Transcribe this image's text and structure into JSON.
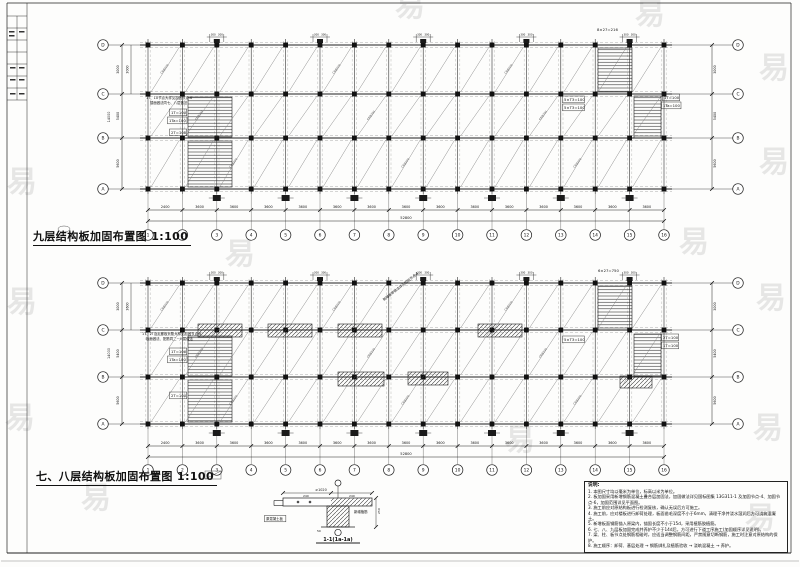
{
  "sheet": {
    "bg": "#fdfdfc",
    "line_color": "#1f1f1f",
    "light_line_color": "#8a8a8a",
    "watermark_glyph": "易",
    "watermark_color": "#8f8f8f"
  },
  "titles": {
    "plan_top": "九层结构板加固布置图 1:100",
    "plan_bottom": "七、八层结构板加固布置图 1:100"
  },
  "plans": [
    {
      "id": "plan-9f",
      "name": "ninth-floor-plan",
      "x0": 148,
      "spacing": 34.4,
      "cols": [
        "1",
        "2",
        "3",
        "4",
        "5",
        "6",
        "7",
        "8",
        "9",
        "10",
        "11",
        "12",
        "13",
        "14",
        "15",
        "16"
      ],
      "rows": [
        {
          "label": "D",
          "y": 45
        },
        {
          "label": "C",
          "y": 94
        },
        {
          "label": "B",
          "y": 138
        },
        {
          "label": "A",
          "y": 189
        }
      ],
      "bottom_dims": [
        "2400",
        "3600",
        "3600",
        "3600",
        "3600",
        "3600",
        "3600",
        "3600",
        "3600",
        "3600",
        "3600",
        "3600",
        "3600",
        "3600",
        "3600"
      ],
      "total_dim": "52800",
      "left_dims": [
        "3000",
        "5400",
        "5600"
      ],
      "right_dims": [
        "3000",
        "5400",
        "5600"
      ],
      "left_total": "14000",
      "inner_dim": "3000",
      "bracket_dim": "300",
      "diag_label": "C8@200",
      "dim_y": 210,
      "total_y": 221,
      "bubble_y": 235,
      "left_bubble_x": 103,
      "right_bubble_x": 738,
      "left_dim_x": 122,
      "right_dim_x": 712,
      "stairs": [
        [
          188,
          97,
          44,
          40
        ],
        [
          188,
          141,
          44,
          46
        ],
        [
          598,
          48,
          34,
          44
        ],
        [
          634,
          96,
          27,
          42
        ]
      ],
      "strips": [],
      "labels": [
        {
          "t": "1T、1U节点大样见加固节点-6",
          "x": 146,
          "y": 99,
          "s": 3.4
        },
        {
          "t": "楼面做法同七、八层做法",
          "x": 150,
          "y": 104,
          "s": 3.4
        },
        {
          "t": "1T=100",
          "x": 171,
          "y": 114,
          "s": 3.8,
          "b": 1
        },
        {
          "t": "1Ta=100",
          "x": 169,
          "y": 122,
          "s": 3.8,
          "b": 1
        },
        {
          "t": "2T=100",
          "x": 171,
          "y": 134,
          "s": 3.8,
          "b": 1
        },
        {
          "t": "5×T3=100",
          "x": 564,
          "y": 101,
          "s": 3.8,
          "b": 1
        },
        {
          "t": "5×T3=100",
          "x": 564,
          "y": 109,
          "s": 3.8,
          "b": 1
        },
        {
          "t": "1T=100",
          "x": 664,
          "y": 99,
          "s": 3.8,
          "b": 1
        },
        {
          "t": "1Ta=100",
          "x": 663,
          "y": 107,
          "s": 3.8,
          "b": 1
        },
        {
          "t": "8×27=216",
          "x": 597,
          "y": 31,
          "s": 3.8
        }
      ]
    },
    {
      "id": "plan-78f",
      "name": "seventh-eighth-floor-plan",
      "x0": 148,
      "spacing": 34.4,
      "cols": [
        "1",
        "2",
        "3",
        "4",
        "5",
        "6",
        "7",
        "8",
        "9",
        "10",
        "11",
        "12",
        "13",
        "14",
        "15",
        "16"
      ],
      "rows": [
        {
          "label": "D",
          "y": 283
        },
        {
          "label": "C",
          "y": 330
        },
        {
          "label": "B",
          "y": 377
        },
        {
          "label": "A",
          "y": 424
        }
      ],
      "bottom_dims": [
        "2400",
        "3600",
        "3600",
        "3600",
        "3600",
        "3600",
        "3600",
        "3600",
        "3600",
        "3600",
        "3600",
        "3600",
        "3600",
        "3600",
        "3600"
      ],
      "total_dim": "52800",
      "left_dims": [
        "3000",
        "5400",
        "5600"
      ],
      "right_dims": [
        "3000",
        "5400",
        "5600"
      ],
      "left_total": "14000",
      "inner_dim": "3600",
      "bracket_dim": "300",
      "diag_label": "C8@200",
      "dim_y": 446,
      "total_y": 457,
      "bubble_y": 470,
      "left_bubble_x": 103,
      "right_bubble_x": 738,
      "left_dim_x": 122,
      "right_dim_x": 712,
      "stairs": [
        [
          188,
          336,
          44,
          40
        ],
        [
          188,
          380,
          44,
          42
        ],
        [
          598,
          286,
          34,
          44
        ],
        [
          634,
          334,
          27,
          42
        ]
      ],
      "strips": [
        [
          198,
          324,
          44,
          13
        ],
        [
          268,
          324,
          44,
          13
        ],
        [
          338,
          324,
          44,
          13
        ],
        [
          478,
          324,
          44,
          13
        ],
        [
          338,
          372,
          46,
          14
        ],
        [
          408,
          372,
          40,
          13
        ],
        [
          620,
          376,
          32,
          12
        ]
      ],
      "labels": [
        {
          "t": "1T、2T及走廊板负筋大样见加固节点-6",
          "x": 142,
          "y": 335,
          "s": 3.4
        },
        {
          "t": "板面做法、配筋同二~六层做法",
          "x": 146,
          "y": 340,
          "s": 3.4
        },
        {
          "t": "1T=100",
          "x": 171,
          "y": 353,
          "s": 3.8,
          "b": 1
        },
        {
          "t": "1Ta=100",
          "x": 169,
          "y": 361,
          "s": 3.8,
          "b": 1
        },
        {
          "t": "2T=100",
          "x": 171,
          "y": 397,
          "s": 3.8,
          "b": 1
        },
        {
          "t": "6×27=750",
          "x": 598,
          "y": 272,
          "s": 3.8
        },
        {
          "t": "5×T3=100",
          "x": 564,
          "y": 341,
          "s": 3.8,
          "b": 1
        },
        {
          "t": "2T=100",
          "x": 663,
          "y": 339,
          "s": 3.8,
          "b": 1
        },
        {
          "t": "1T=100",
          "x": 663,
          "y": 347,
          "s": 3.8,
          "b": 1
        },
        {
          "t": "新增板带做法详见加固节点-4",
          "x": 384,
          "y": 301,
          "s": 3.4,
          "rot": -38
        }
      ]
    }
  ],
  "detail": {
    "title": "1-1(1a-1a)",
    "labels": [
      {
        "t": "≥1020",
        "x": 321,
        "y": 491,
        "s": 3.4,
        "a": "middle"
      },
      {
        "t": "240",
        "x": 303,
        "y": 497,
        "s": 3
      },
      {
        "t": "240",
        "x": 349,
        "y": 497,
        "s": 3
      },
      {
        "t": "原混凝土板",
        "x": 266,
        "y": 520,
        "s": 3.4,
        "b": 1
      },
      {
        "t": "新增植筋",
        "x": 354,
        "y": 513,
        "s": 3.4
      },
      {
        "t": "50",
        "x": 317,
        "y": 532,
        "s": 3
      },
      {
        "t": "250",
        "x": 380,
        "y": 514,
        "s": 3,
        "rot": -90
      }
    ]
  },
  "notes": {
    "heading": "说明:",
    "items": [
      "1. 本图尺寸均以毫米为单位，标高以米为单位。",
      "2. 板加固采用新增钢筋混凝土叠合层加固法，加固做法详见国标图集 13G311-1 及加固节点-4、加固节点-6，加固范围详见平面图。",
      "3. 施工前应对原结构板进行检测复核，确认无误后方可施工。",
      "4. 施工前，应对楼板进行卸荷处理，板面凿毛深度不小于6mm，清理干净并浇水湿润后方可浇筑混凝土。",
      "5. 新增板面钢筋锚入原梁内，锚固长度不小于15d，采用植筋胶植筋。",
      "6. 七、八、九层板加固完成并养护不少于14d后，方可进行下道工序施工(加固顺序详见说明)。",
      "7. 梁、柱、板节点处钢筋相碰时，应适当调整钢筋间距，严禁随意切断钢筋，施工时注意对原结构的保护。",
      "8. 施工顺序：卸荷、基层处理 → 钢筋绑扎及植筋验收 → 浇筑混凝土 → 养护。"
    ]
  },
  "watermarks": [
    [
      22,
      192
    ],
    [
      22,
      312
    ],
    [
      20,
      428
    ],
    [
      96,
      508
    ],
    [
      774,
      78
    ],
    [
      774,
      172
    ],
    [
      771,
      308
    ],
    [
      768,
      438
    ],
    [
      760,
      528
    ],
    [
      410,
      16
    ],
    [
      650,
      24
    ],
    [
      240,
      264
    ],
    [
      520,
      450
    ],
    [
      694,
      252
    ]
  ]
}
